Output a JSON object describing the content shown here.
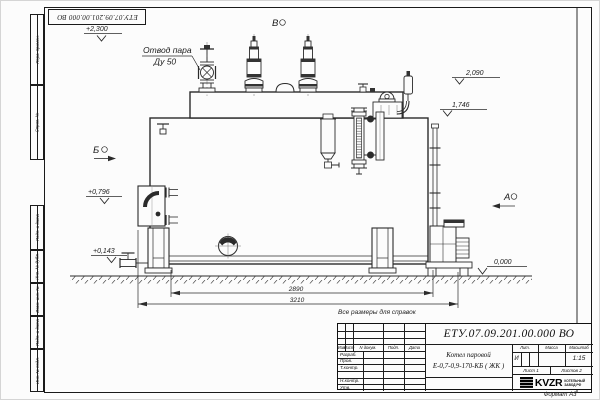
{
  "colors": {
    "line": "#2b2b2b",
    "paper": "#fcfcfc"
  },
  "sheet": {
    "side_labels": [
      "Перв. примен.",
      "Справ. №",
      "Подп. и дата",
      "Инв. № дубл.",
      "Взам. инв. №",
      "Подп. и дата",
      "Инв. № подл."
    ],
    "top_stamp": "ЕТУ.07.09.201.00.000  ВО",
    "note": "Все размеры для справок",
    "format_label": "Формат А3"
  },
  "drawing": {
    "callout": {
      "line1": "Отвод пара",
      "line2": "Ду 50"
    },
    "views": {
      "a": "А",
      "b": "Б",
      "v": "В"
    },
    "levels": {
      "top": "+2,300",
      "drum": "2,090",
      "mid": "1,746",
      "burner": "+0,796",
      "low": "+0,143",
      "ground": "0,000"
    },
    "dimensions": {
      "body_length": "2890",
      "total_length": "3210"
    }
  },
  "title_block": {
    "doc_number": "ЕТУ.07.09.201.00.000  ВО",
    "product_name_line1": "Котел паровой",
    "product_name_line2": "Е-0,7-0,9-170-КБ ( ЖК )",
    "col_headers": {
      "izm": "Изм",
      "list": "Лист",
      "doc": "N докум.",
      "podp": "Подп.",
      "data": "Дата"
    },
    "row_labels": [
      "Разраб.",
      "Пров.",
      "Т.контр.",
      "Н.контр.",
      "Утв."
    ],
    "prop_headers": {
      "lit": "Лит.",
      "mass": "Масса",
      "scale": "Масштаб"
    },
    "lit_value": "И",
    "scale_value": "1:15",
    "sheet_info": "Лист 1",
    "sheets_info": "Листов 2",
    "logo": {
      "text": "KVZR",
      "sub1": "КОТЕЛЬНЫЙ",
      "sub2": "ЗАВОД РФ"
    }
  }
}
